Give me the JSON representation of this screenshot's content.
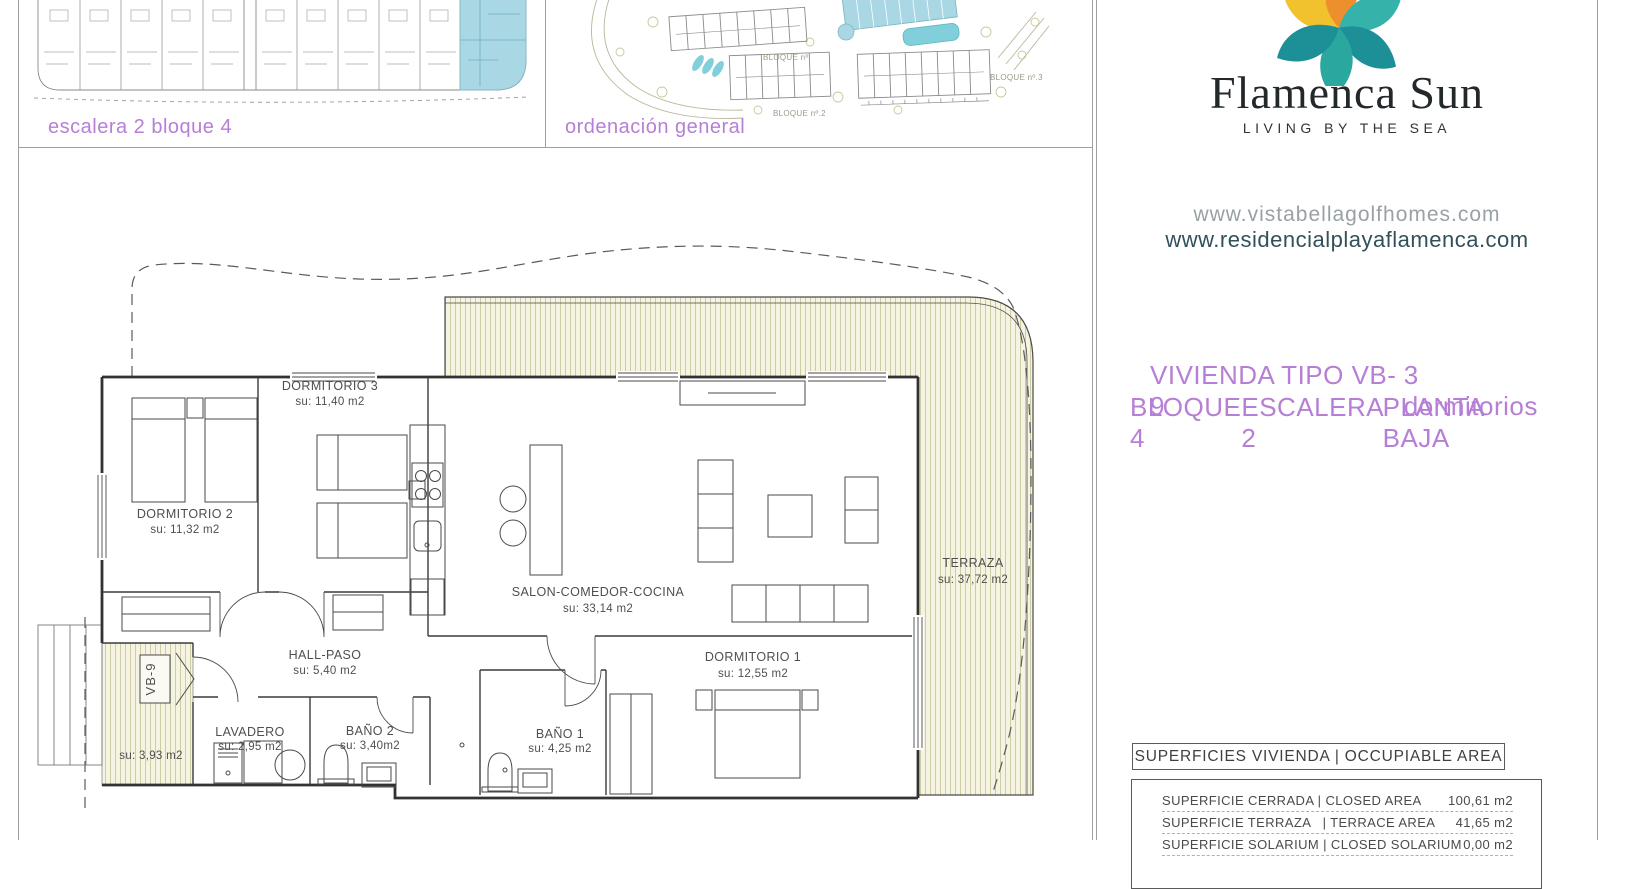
{
  "brand": {
    "name": "Flamenca Sun",
    "tagline": "LIVING BY THE SEA",
    "website_primary": "www.vistabellagolfhomes.com",
    "website_secondary": "www.residencialplayaflamenca.com"
  },
  "thumbnails": {
    "plan_label": "escalera 2 bloque 4",
    "site_label": "ordenación general",
    "site_blocks": {
      "b1": "BLOQUE nº",
      "b2": "BLOQUE nº.2",
      "b3": "BLOQUE nº.3"
    }
  },
  "unit": {
    "type_title": "VIVIENDA TIPO VB-9",
    "bedrooms": "3 dormitorios",
    "block": "BLOQUE 4",
    "stair": "ESCALERA 2",
    "floor": "PLANTA BAJA"
  },
  "plan": {
    "rooms": [
      {
        "name": "DORMITORIO 3",
        "area": "su: 11,40 m2"
      },
      {
        "name": "DORMITORIO 2",
        "area": "su: 11,32 m2"
      },
      {
        "name": "SALON-COMEDOR-COCINA",
        "area": "su: 33,14 m2"
      },
      {
        "name": "DORMITORIO 1",
        "area": "su: 12,55 m2"
      },
      {
        "name": "TERRAZA",
        "area": "su: 37,72 m2"
      },
      {
        "name": "HALL-PASO",
        "area": "su: 5,40 m2"
      },
      {
        "name": "LAVADERO",
        "area": "su: 2,95 m2"
      },
      {
        "name": "BAÑO 2",
        "area": "su: 3,40m2"
      },
      {
        "name": "BAÑO 1",
        "area": "su: 4,25 m2"
      },
      {
        "name": "VB-9",
        "area": "su: 3,93 m2"
      }
    ]
  },
  "areas_table": {
    "title": "SUPERFICIES VIVIENDA | OCCUPIABLE AREA",
    "rows": [
      {
        "label": "SUPERFICIE CERRADA | CLOSED AREA",
        "value": "100,61 m2"
      },
      {
        "label": "SUPERFICIE TERRAZA   | TERRACE AREA",
        "value": "41,65 m2"
      },
      {
        "label": "SUPERFICIE SOLARIUM | CLOSED SOLARIUM",
        "value": "0,00 m2"
      }
    ]
  },
  "colors": {
    "accent_purple": "#b67fd5",
    "highlight_blue": "#a9d8e4",
    "terrace_hatch_bg": "#f5f3e1",
    "terrace_hatch_line": "#cbc89e",
    "logo_teal": "#2aa79e",
    "logo_dark_teal": "#1d8f96",
    "logo_yellow": "#f2c12e",
    "logo_orange": "#ee8f2e"
  }
}
